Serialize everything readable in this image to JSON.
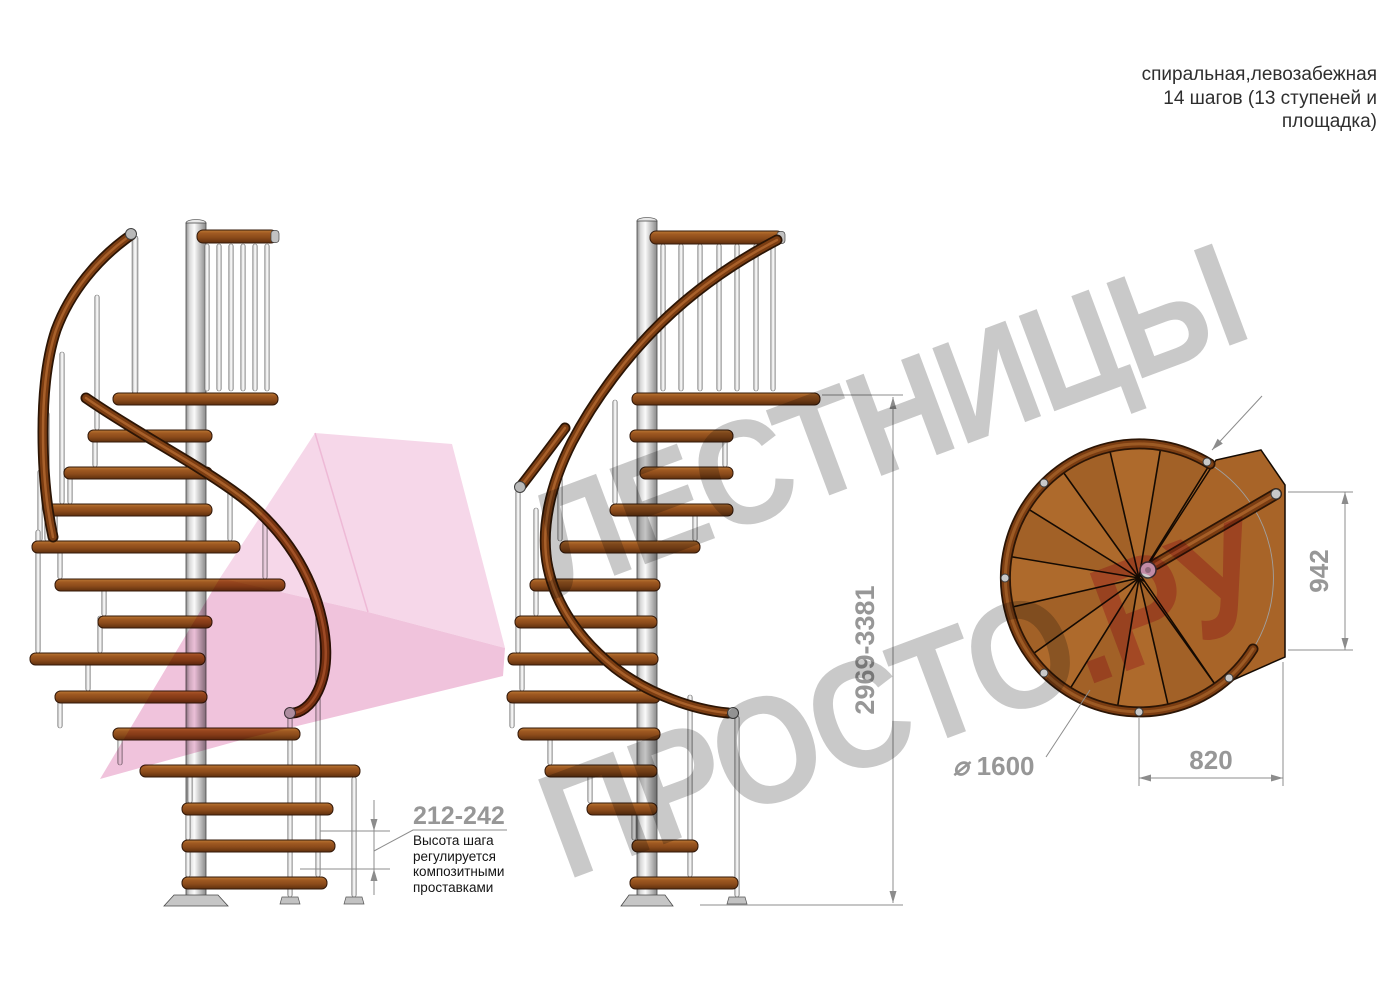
{
  "title": {
    "line1": "спиральная,левозабежная",
    "line2": "14 шагов (13 ступеней и",
    "line3": "площадка)"
  },
  "watermark": {
    "word1": "ЛЕСТНИЦЫ",
    "word2": "ПРОСТО",
    "word2_suffix": ".РУ"
  },
  "dimensions": {
    "total_height_mm": "2969-3381",
    "step_height_mm": "212-242",
    "landing_depth_mm": "942",
    "landing_width_mm": "820",
    "diameter_symbol": "⌀",
    "diameter_mm": "1600"
  },
  "annotation": {
    "line1": "Высота шага",
    "line2": "регулируется",
    "line3": "композитными",
    "line4": "проставками"
  },
  "colors": {
    "wood": "#ae6a2c",
    "handrail": "#7b3d12",
    "column": "#d9d9d9",
    "watermark_gray": "#c9c9c9",
    "watermark_pink": "#efadce",
    "logo_pink": "#f6d7e9",
    "dimension_gray": "#8c8c8c"
  }
}
